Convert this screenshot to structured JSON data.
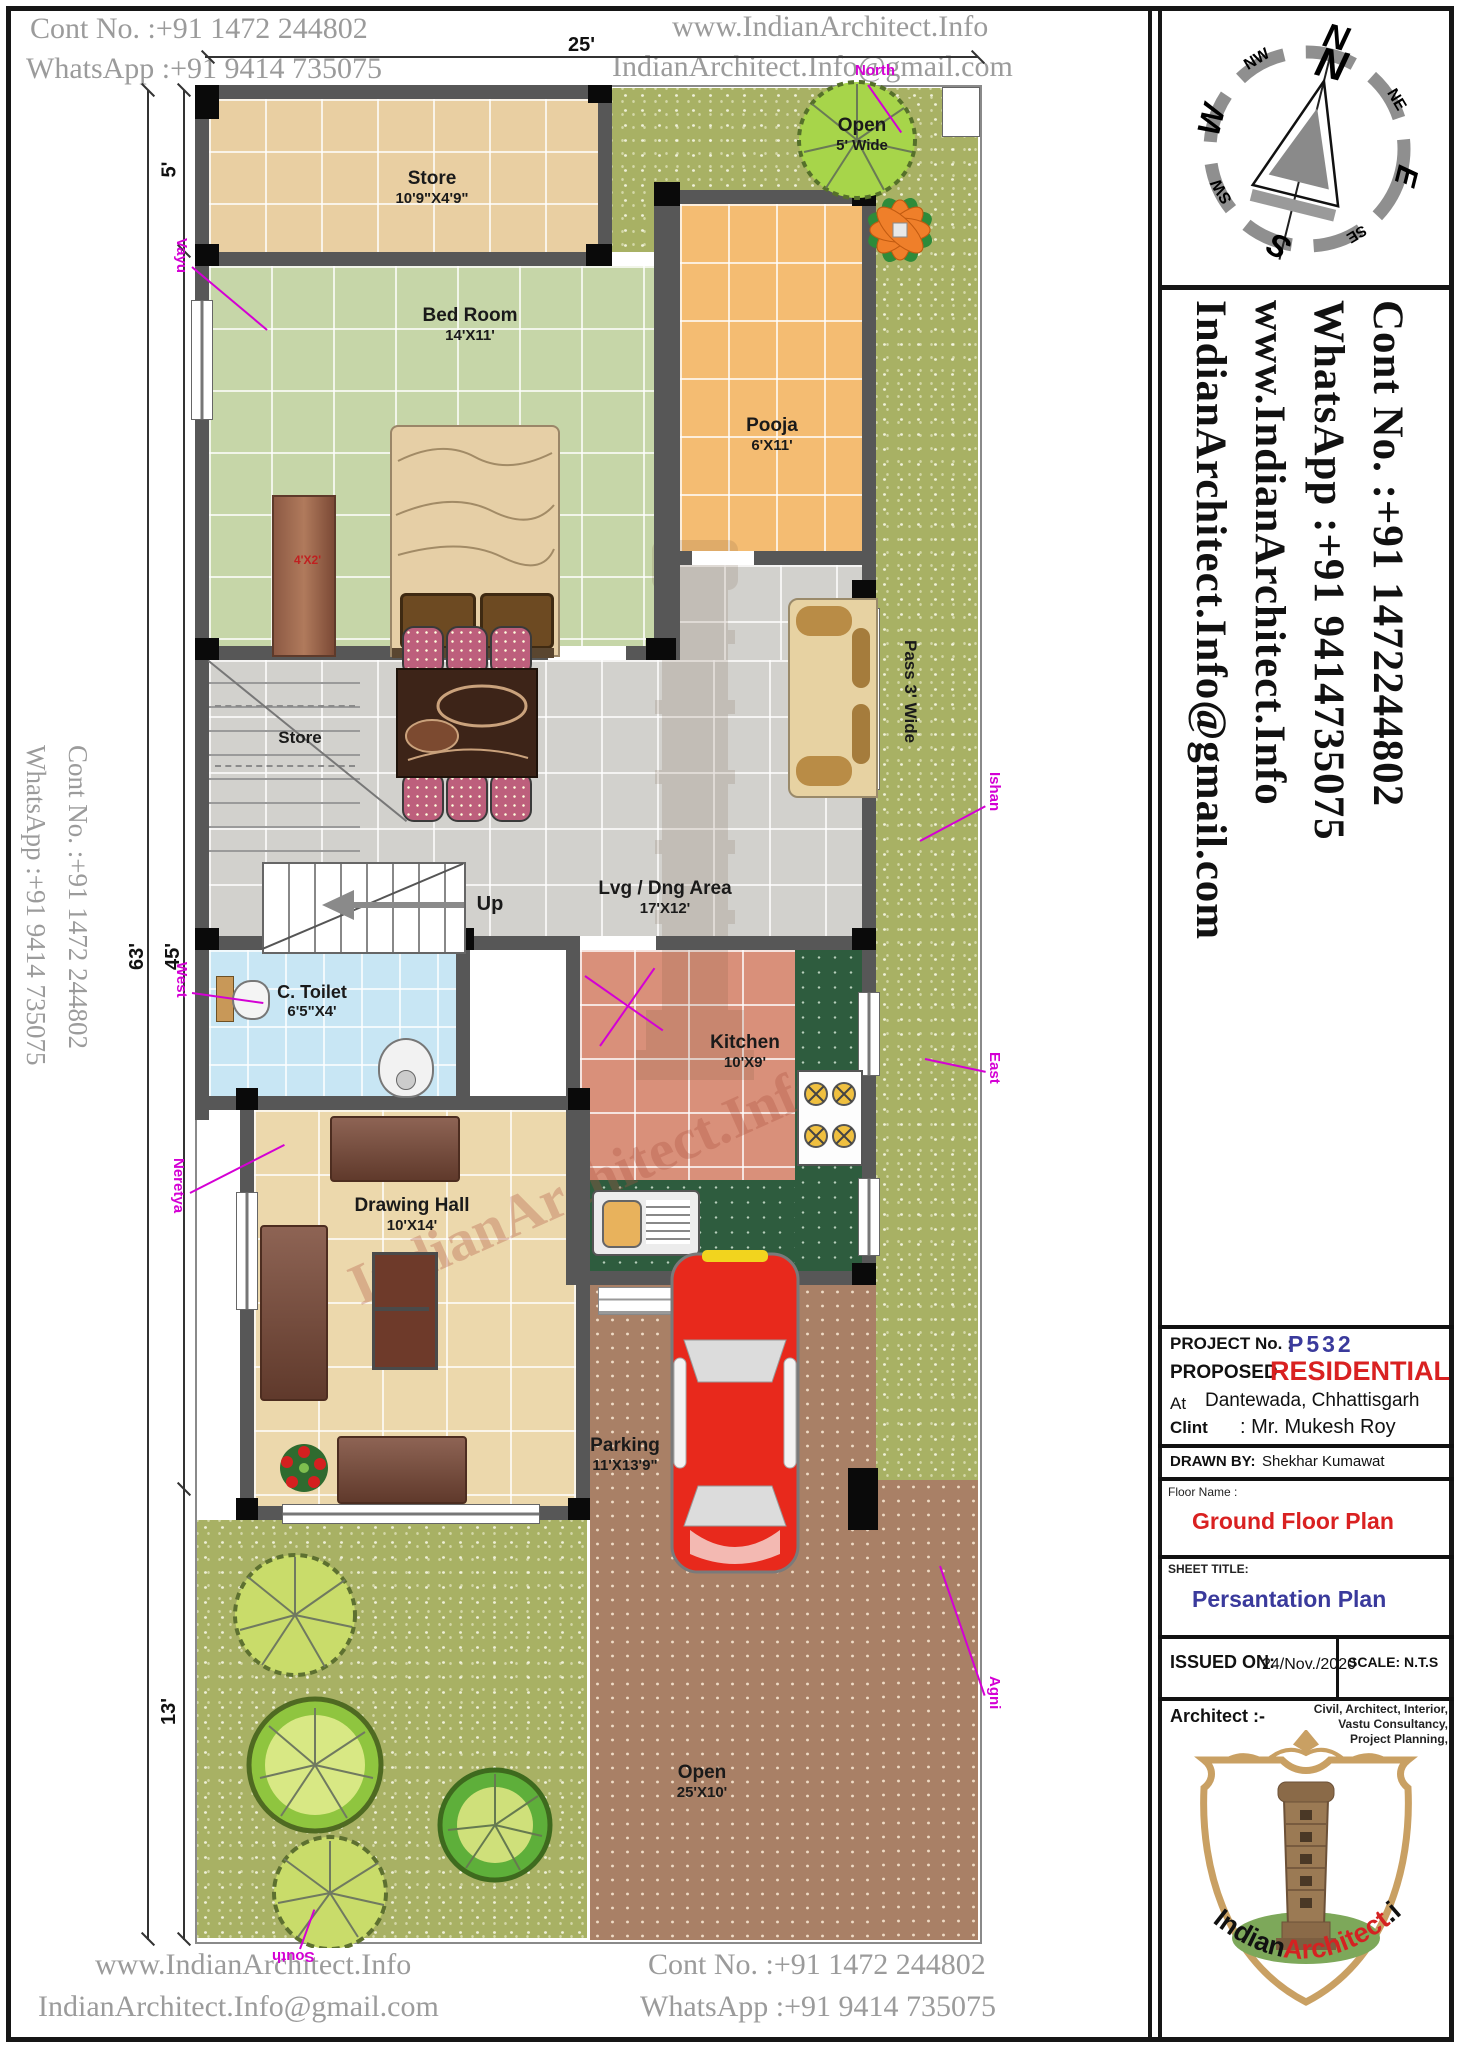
{
  "page": {
    "header": {
      "contact_line1": "Cont No. :+91 1472 244802",
      "contact_line2": "WhatsApp :+91 9414 735075",
      "site_line1": "www.IndianArchitect.Info",
      "site_line2": "IndianArchitect.Info@gmail.com"
    },
    "footer": {
      "site_line1": "www.IndianArchitect.Info",
      "site_line2": "IndianArchitect.Info@gmail.com",
      "contact_line1": "Cont No. :+91 1472 244802",
      "contact_line2": "WhatsApp :+91 9414 735075"
    },
    "left_margin": {
      "contact_line1": "Cont No. :+91 1472 244802",
      "contact_line2": "WhatsApp :+91 9414 735075"
    }
  },
  "right_panel": {
    "compass": {
      "labels": [
        "N",
        "NE",
        "E",
        "SE",
        "S",
        "SW",
        "W",
        "NW"
      ],
      "needle_letter": "N"
    },
    "contact_vertical": [
      "Cont No. :+91 1472244802",
      "WhatsApp :+91 9414735075",
      "www.IndianArchitect.Info",
      "IndianArchitect.Info@gmail.com"
    ],
    "title_block": {
      "project_no_label": "PROJECT No. :",
      "project_no": "P532",
      "proposed_label": "PROPOSED",
      "proposed_value": "RESIDENTIAL",
      "at_label": "At",
      "at_value": "Dantewada, Chhattisgarh",
      "client_label": "Clint",
      "client_value": ": Mr. Mukesh Roy",
      "drawn_by_label": "DRAWN BY:",
      "drawn_by_value": "Shekhar Kumawat",
      "floor_name_label": "Floor Name :",
      "floor_name_value": "Ground Floor Plan",
      "sheet_title_label": "SHEET TITLE:",
      "sheet_title_value": "Persantation Plan",
      "issued_on_label": "ISSUED ON:",
      "issued_on_value": "24/Nov./2020",
      "scale_value": "SCALE: N.T.S",
      "architect_label": "Architect :-",
      "services": [
        "Civil, Architect, Interior,",
        "Vastu Consultancy,",
        "Project Planning,"
      ],
      "logo": {
        "part1": "Indian",
        "part2": "Architect",
        "part3": ".info"
      }
    }
  },
  "plan": {
    "dimensions": {
      "width": "25'",
      "total_height": "63'",
      "house_height": "45'",
      "store_height": "5'",
      "garden_height": "13'"
    },
    "rooms": {
      "store_top": {
        "name": "Store",
        "size": "10'9\"X4'9\""
      },
      "open_top": {
        "name": "Open",
        "size": "5' Wide"
      },
      "bed_room": {
        "name": "Bed  Room",
        "size": "14'X11'"
      },
      "pooja": {
        "name": "Pooja",
        "size": "6'X11'"
      },
      "living": {
        "name": "Lvg / Dng Area",
        "size": "17'X12'"
      },
      "store_under_stairs": {
        "name": "Store"
      },
      "toilet": {
        "name": "C. Toilet",
        "size": "6'5\"X4'"
      },
      "kitchen": {
        "name": "Kitchen",
        "size": "10'X9'"
      },
      "drawing_hall": {
        "name": "Drawing Hall",
        "size": "10'X14'"
      },
      "parking": {
        "name": "Parking",
        "size": "11'X13'9\""
      },
      "open_bottom": {
        "name": "Open",
        "size": "25'X10'"
      },
      "pass": {
        "name": "Pass 3' Wide"
      }
    },
    "labels": {
      "up": "Up",
      "wardrobe": "4'X2'"
    },
    "directions": {
      "north": "North",
      "south": "South",
      "east": "East",
      "west": "West",
      "vayu": "Vayu",
      "ishan": "Ishan",
      "agni": "Agni",
      "neretya": "Neretya"
    },
    "watermark": "IndianArchitect.Info"
  },
  "colors": {
    "wall": "#575757",
    "store_floor": "#e9cfa2",
    "bedroom_floor": "#c6d6a8",
    "pooja_floor": "#f4bc72",
    "living_floor": "#d2d1cd",
    "toilet_floor": "#c8e6f4",
    "kitchen_floor": "#d9907a",
    "counter_green": "#2e5c3e",
    "drawing_floor": "#ecd8ac",
    "grass": "#a8b164",
    "open_ground": "#a98066",
    "accent_red": "#d92121",
    "accent_navy": "#3a3a9c",
    "magenta": "#d400d4"
  }
}
